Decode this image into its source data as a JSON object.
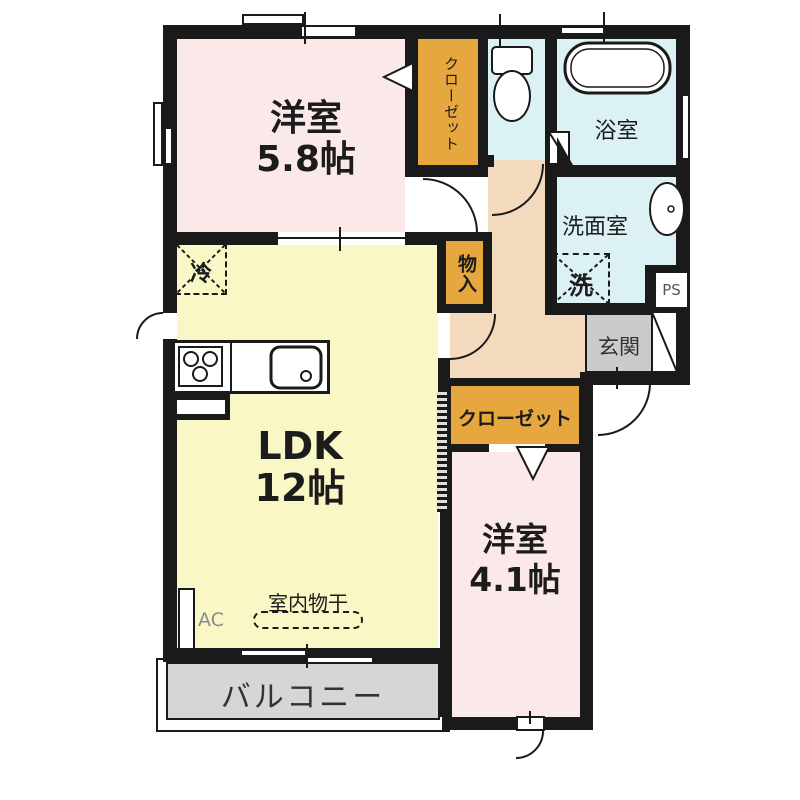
{
  "rooms": {
    "bedroom1": {
      "name": "洋室",
      "size": "5.8帖"
    },
    "ldk": {
      "name": "LDK",
      "size": "12帖"
    },
    "bedroom2": {
      "name": "洋室",
      "size": "4.1帖"
    },
    "bath": {
      "name": "浴室"
    },
    "washroom": {
      "name": "洗面室"
    },
    "entrance": {
      "name": "玄関"
    },
    "balcony": {
      "name": "バルコニー"
    },
    "closet_upper": {
      "name": "クローゼット"
    },
    "closet_lower": {
      "name": "クローゼット"
    },
    "storage": {
      "name": "物入"
    }
  },
  "fixtures": {
    "refrigerator": "冷",
    "washer": "洗",
    "indoor_drying": "室内物干",
    "ac_unit": "AC",
    "pipe_space": "PS"
  },
  "colors": {
    "room_pink": "#FAE9E8",
    "ldk_yellow": "#FAF7C6",
    "wet_cyan": "#DCF1F3",
    "closet_orange": "#E6A73E",
    "hall_beige": "#F3D9BD",
    "entrance_gray": "#CBCBCB",
    "balcony_gray": "#D6D6D6",
    "wall_black": "#1A1A1A"
  }
}
